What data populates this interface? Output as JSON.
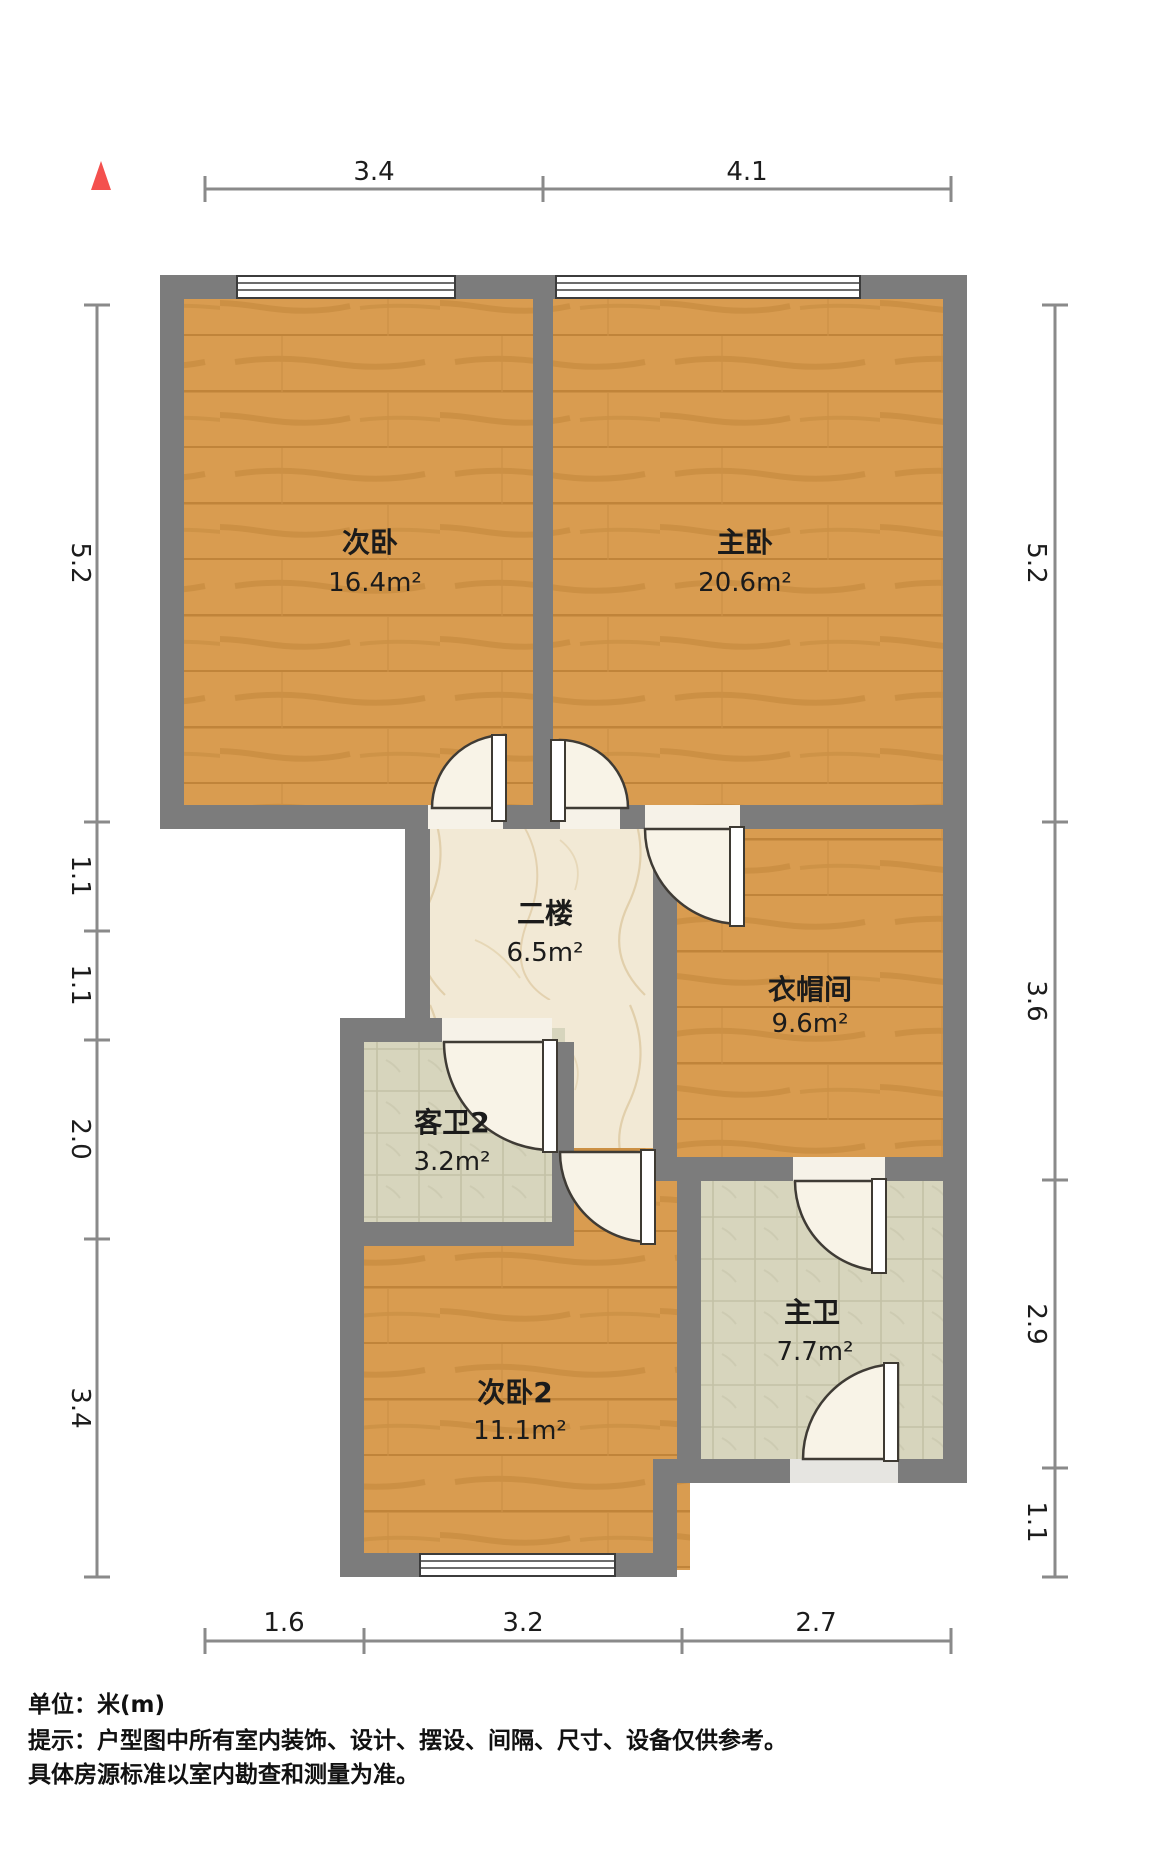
{
  "plan": {
    "title": "floor-plan",
    "north_arrow": "north",
    "colors": {
      "wall": "#7c7c7c",
      "wood_floor": "#d99c50",
      "marble_floor": "#f2e9d5",
      "tile_floor": "#d7d5bd",
      "north_arrow_red": "#f4504e",
      "dimension_line": "#8a8a8a",
      "text": "#1b1b1b"
    },
    "dimensions": {
      "top": [
        "3.4",
        "4.1"
      ],
      "left": [
        "5.2",
        "1.1",
        "1.1",
        "2.0",
        "3.4"
      ],
      "right": [
        "5.2",
        "3.6",
        "2.9",
        "1.1"
      ],
      "bottom": [
        "1.6",
        "3.2",
        "2.7"
      ]
    },
    "rooms": [
      {
        "name": "次卧",
        "area": "16.4m²"
      },
      {
        "name": "主卧",
        "area": "20.6m²"
      },
      {
        "name": "二楼",
        "area": "6.5m²"
      },
      {
        "name": "衣帽间",
        "area": "9.6m²"
      },
      {
        "name": "客卫2",
        "area": "3.2m²"
      },
      {
        "name": "次卧2",
        "area": "11.1m²"
      },
      {
        "name": "主卫",
        "area": "7.7m²"
      }
    ],
    "footer": {
      "unit_label": "单位：米(m)",
      "note_line1": "提示：户型图中所有室内装饰、设计、摆设、间隔、尺寸、设备仅供参考。",
      "note_line2": "具体房源标准以室内勘查和测量为准。"
    }
  }
}
